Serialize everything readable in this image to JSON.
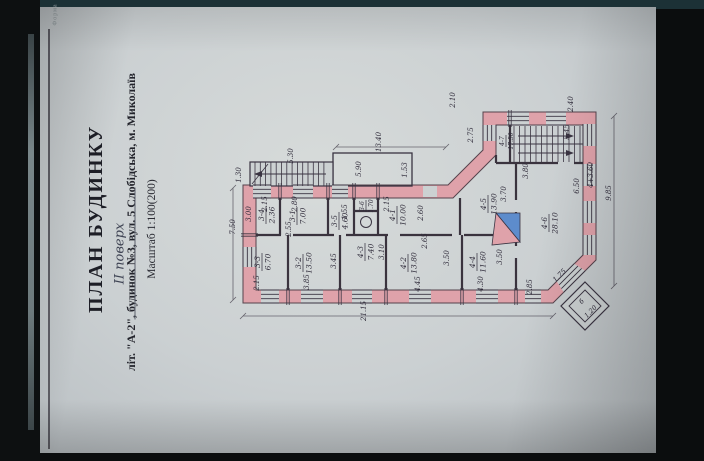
{
  "stamp": {
    "form_note": "Форма",
    "title": "ПЛАН БУДИНКУ",
    "subtitle": "літ. \"А-2\", будинок №3, вул. 5 Слобідська, м. Миколаїв",
    "scale": "Масштаб 1:100(200)",
    "handwritten_floor": "ІІ поверх"
  },
  "plan": {
    "rooms": [
      {
        "id": "3-4",
        "area": "2.36",
        "x": 266,
        "y": 215
      },
      {
        "id": "3-1",
        "area": "7.00",
        "x": 297,
        "y": 216
      },
      {
        "id": "3-5",
        "area": "4.60",
        "x": 339,
        "y": 221
      },
      {
        "id": "3-6",
        "area": "1.70",
        "x": 366,
        "y": 206,
        "s": "small"
      },
      {
        "id": "4-1",
        "area": "10.00",
        "x": 397,
        "y": 215
      },
      {
        "id": "4-5",
        "area": "13.90",
        "x": 488,
        "y": 204
      },
      {
        "id": "4-6",
        "area": "28.10",
        "x": 549,
        "y": 223
      },
      {
        "id": "4-7",
        "area": "17.50",
        "x": 506,
        "y": 141,
        "s": "small"
      },
      {
        "id": "3-3",
        "area": "6.70",
        "x": 262,
        "y": 262
      },
      {
        "id": "3-2",
        "area": "13.50",
        "x": 303,
        "y": 263
      },
      {
        "id": "4-3",
        "area": "7.40",
        "x": 365,
        "y": 252
      },
      {
        "id": "4-2",
        "area": "13.80",
        "x": 408,
        "y": 263
      },
      {
        "id": "4-4",
        "area": "11.60",
        "x": 477,
        "y": 262
      }
    ],
    "dims": [
      {
        "v": "7.50",
        "x": 235,
        "y": 227
      },
      {
        "v": "1.30",
        "x": 241,
        "y": 175
      },
      {
        "v": "5.30",
        "x": 293,
        "y": 156
      },
      {
        "v": "5.90",
        "x": 361,
        "y": 169
      },
      {
        "v": "1.53",
        "x": 407,
        "y": 170
      },
      {
        "v": "13.40",
        "x": 381,
        "y": 142
      },
      {
        "v": "2.10",
        "x": 455,
        "y": 100
      },
      {
        "v": "2.75",
        "x": 473,
        "y": 135
      },
      {
        "v": "2.40",
        "x": 573,
        "y": 104
      },
      {
        "v": "5.45",
        "x": 569,
        "y": 132
      },
      {
        "v": "3.80",
        "x": 528,
        "y": 171
      },
      {
        "v": "4+3.60",
        "x": 593,
        "y": 175
      },
      {
        "v": "6.50",
        "x": 579,
        "y": 186
      },
      {
        "v": "9.85",
        "x": 611,
        "y": 193
      },
      {
        "v": "21.15",
        "x": 366,
        "y": 311
      },
      {
        "v": "2.15",
        "x": 267,
        "y": 204
      },
      {
        "v": "2.80",
        "x": 297,
        "y": 204
      },
      {
        "v": "2.15",
        "x": 389,
        "y": 204
      },
      {
        "v": "3.00",
        "x": 251,
        "y": 214
      },
      {
        "v": "2.55",
        "x": 291,
        "y": 229
      },
      {
        "v": "1.55",
        "x": 347,
        "y": 212
      },
      {
        "v": "2.60",
        "x": 423,
        "y": 213
      },
      {
        "v": "2.65",
        "x": 427,
        "y": 241
      },
      {
        "v": "3.45",
        "x": 336,
        "y": 261
      },
      {
        "v": "3.10",
        "x": 384,
        "y": 252
      },
      {
        "v": "3.50",
        "x": 449,
        "y": 258
      },
      {
        "v": "3.70",
        "x": 506,
        "y": 194
      },
      {
        "v": "3.50",
        "x": 502,
        "y": 257
      },
      {
        "v": "2.15",
        "x": 259,
        "y": 283
      },
      {
        "v": "3.85",
        "x": 309,
        "y": 282
      },
      {
        "v": "4.45",
        "x": 420,
        "y": 284
      },
      {
        "v": "4.30",
        "x": 483,
        "y": 284
      },
      {
        "v": "2.85",
        "x": 532,
        "y": 287
      },
      {
        "v": "1.75",
        "x": 561,
        "y": 277,
        "r": -45
      }
    ],
    "balcony": {
      "label": "б",
      "dim": "1.20"
    },
    "colors": {
      "wall": "#dfa2aa",
      "stove_blue": "#5d8ccc",
      "ink": "#3a3442",
      "paper": "#ccd1d2"
    }
  }
}
